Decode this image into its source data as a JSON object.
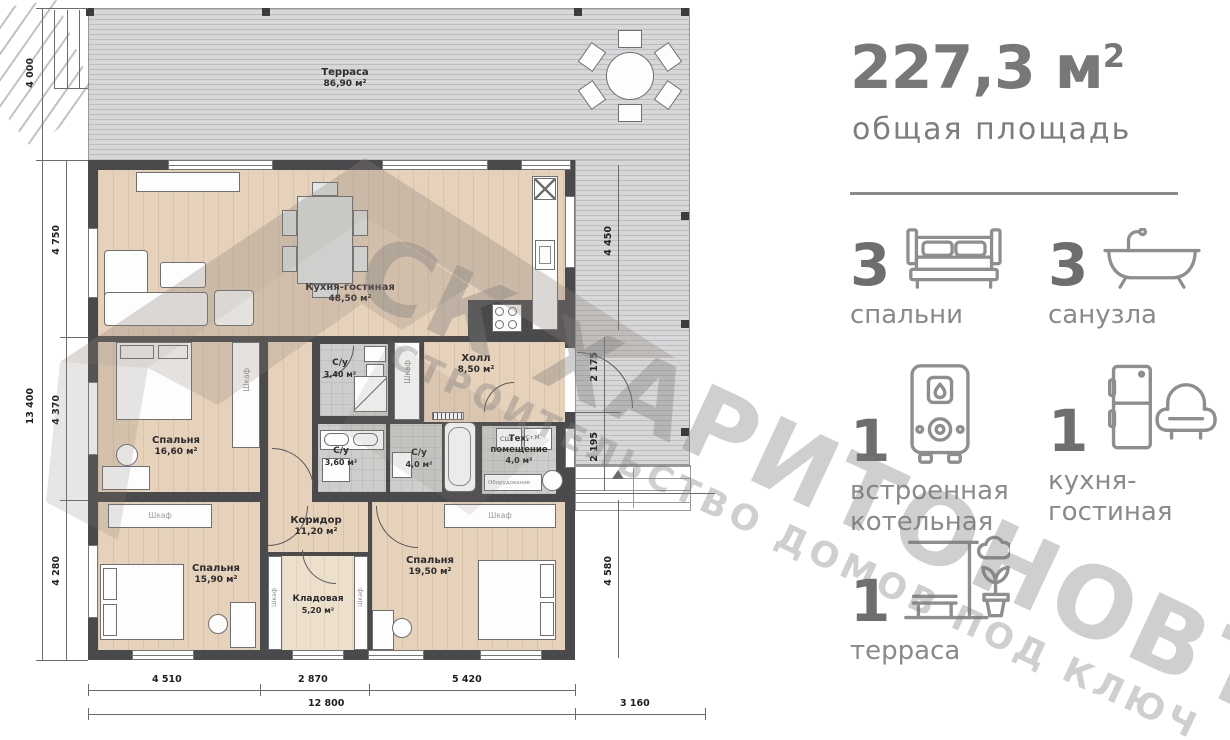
{
  "watermark": {
    "brand": "СК ХАРИТОНОВЪ",
    "tagline": "СТРОИТЕЛЬСТВО ДОМОВ ПОД КЛЮЧ"
  },
  "summary": {
    "area_value": "227,3",
    "area_unit": "м",
    "area_sup": "2",
    "area_caption": "общая площадь",
    "stats": [
      {
        "count": "3",
        "label1": "спальни",
        "label2": "",
        "icon": "bed-icon"
      },
      {
        "count": "3",
        "label1": "санузла",
        "label2": "",
        "icon": "bathtub-icon"
      },
      {
        "count": "1",
        "label1": "встроенная",
        "label2": "котельная",
        "icon": "boiler-icon"
      },
      {
        "count": "1",
        "label1": "кухня-",
        "label2": "гостиная",
        "icon": "kitchen-living-icon"
      },
      {
        "count": "1",
        "label1": "терраса",
        "label2": "",
        "icon": "terrace-icon"
      }
    ]
  },
  "plan": {
    "rooms": {
      "terrace": {
        "name": "Терраса",
        "area": "86,90 м²"
      },
      "kitchen_living": {
        "name": "Кухня-гостиная",
        "area": "48,50 м²"
      },
      "bedroom1": {
        "name": "Спальня",
        "area": "16,60 м²"
      },
      "hall": {
        "name": "Холл",
        "area": "8,50 м²"
      },
      "bath1": {
        "name": "С/у",
        "area": "3,40 м²"
      },
      "bath2": {
        "name": "С/у",
        "area": "3,60 м²"
      },
      "bath3": {
        "name": "С/у",
        "area": "4,0 м²"
      },
      "tech": {
        "name": "Тех.",
        "name2": "помещение",
        "area": "4,0 м²"
      },
      "corridor": {
        "name": "Коридор",
        "area": "11,20 м²"
      },
      "bedroom2": {
        "name": "Спальня",
        "area": "15,90 м²"
      },
      "pantry": {
        "name": "Кладовая",
        "area": "5,20 м²"
      },
      "bedroom3": {
        "name": "Спальня",
        "area": "19,50 м²"
      }
    },
    "labels": {
      "closet": "Шкаф",
      "dryer": "СШ",
      "washer": "Ст.М.",
      "equipment": "Оборудование"
    },
    "dims": {
      "left_top": "4 000",
      "left_total": "13 400",
      "left_segments": [
        "4 750",
        "4 370",
        "4 280"
      ],
      "right_segments": [
        "4 450",
        "2 175",
        "2 195",
        "4 580"
      ],
      "bottom_segments": [
        "4 510",
        "2 870",
        "5 420"
      ],
      "bottom_total": "12 800",
      "bottom_right": "3 160"
    },
    "colors": {
      "wall": "#4a4a4c",
      "wood_floor": "#e6d1ba",
      "tile_floor": "#cdcdcb",
      "terrace_deck": "#d7d7d9",
      "stat_gray": "#8a8a8a"
    }
  }
}
